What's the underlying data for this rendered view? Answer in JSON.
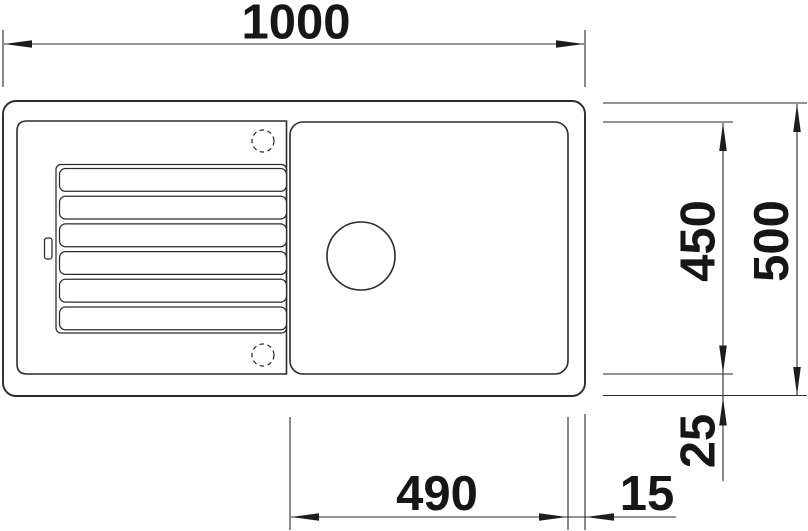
{
  "drawing": {
    "colors": {
      "line": "#2b2b28",
      "text": "#161614",
      "background": "#ffffff"
    },
    "dimensions": {
      "overall_width": {
        "value": "1000",
        "orientation": "horizontal",
        "position": "top"
      },
      "overall_depth": {
        "value": "500",
        "orientation": "vertical",
        "position": "right-outer"
      },
      "bowl_depth": {
        "value": "450",
        "orientation": "vertical",
        "position": "right-inner"
      },
      "bowl_edge_gap_bottom": {
        "value": "25",
        "orientation": "vertical",
        "position": "right-lower"
      },
      "bowl_width": {
        "value": "490",
        "orientation": "horizontal",
        "position": "bottom"
      },
      "bowl_edge_gap_right": {
        "value": "15",
        "orientation": "horizontal",
        "position": "bottom-right"
      }
    },
    "features": {
      "sink_outline": "outer rounded rectangle",
      "rim_inner_outline": "inner rounded rectangle (drainboard area)",
      "drainer_tray": "ribbed drainboard with 6 grooves",
      "overflow_slot": "small slot on left rim",
      "tap_hole_top": "dashed circle (optional tap hole, top)",
      "tap_hole_bottom": "dashed circle (optional tap hole, bottom)",
      "bowl": "rounded square bowl, right side",
      "drain_hole": "circular drain in bowl"
    }
  }
}
